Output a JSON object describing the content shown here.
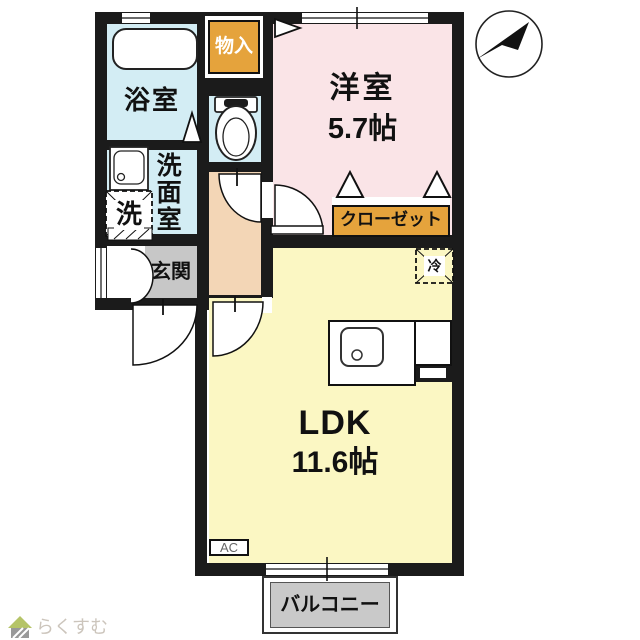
{
  "rooms": {
    "bathroom": {
      "label": "浴室"
    },
    "storage": {
      "label": "物入"
    },
    "western_room": {
      "label": "洋室",
      "size": "5.7帖"
    },
    "washroom": {
      "label": "洗面室"
    },
    "washing_machine": {
      "label": "洗"
    },
    "entrance": {
      "label": "玄関"
    },
    "closet": {
      "label": "クローゼット"
    },
    "refrigerator": {
      "label": "冷"
    },
    "ldk": {
      "label": "LDK",
      "size": "11.6帖"
    },
    "air_conditioner": {
      "label": "AC"
    },
    "balcony": {
      "label": "バルコニー"
    }
  },
  "logo": {
    "text": "らくすむ"
  },
  "icons": [
    "north-compass-icon",
    "toilet-icon",
    "bathtub-icon",
    "sink-icon",
    "kitchen-sink-icon",
    "house-logo-icon"
  ],
  "colors": {
    "wall": "#1b1b1b",
    "wet_area": "#d3edf4",
    "western_room": "#fae4e7",
    "ldk": "#fbf7c3",
    "hallway": "#f3d6b6",
    "entrance_floor": "#c7c7c7",
    "storage_accent": "#e5a33c",
    "balcony_floor": "#c9c9c9"
  }
}
